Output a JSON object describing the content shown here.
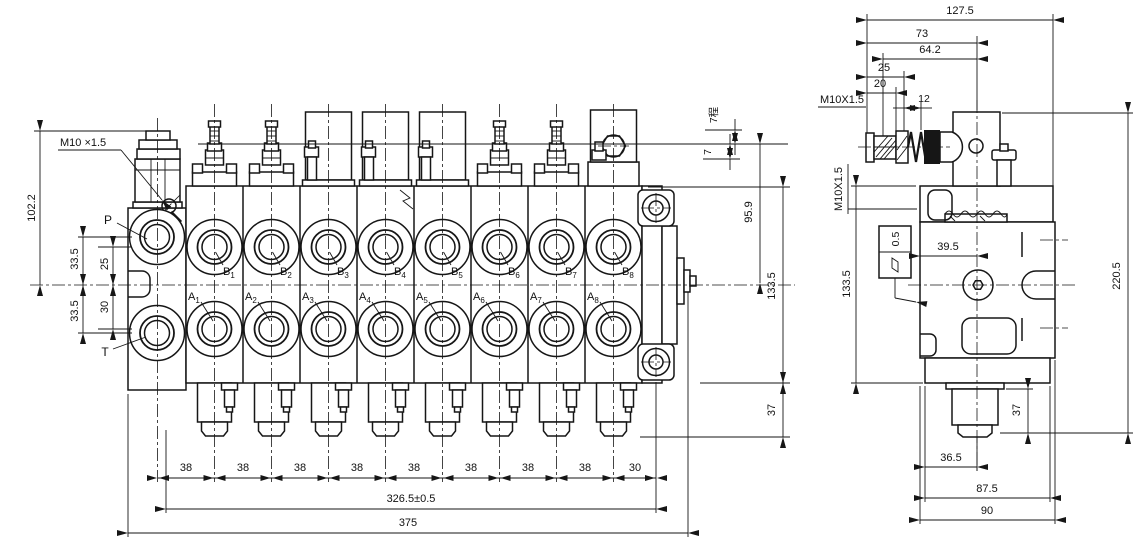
{
  "front": {
    "thread_label": "M10 ×1.5",
    "port_p": "P",
    "port_t": "T",
    "port_letter_a": "A",
    "port_letter_b": "B",
    "indices": [
      "1",
      "2",
      "3",
      "4",
      "5",
      "6",
      "7",
      "8"
    ],
    "dims": {
      "height_102": "102.2",
      "p_off": "33.5",
      "b_off": "25",
      "a_off": "30",
      "t_off": "33.5",
      "pitch": "38",
      "pitch_end": "30",
      "total_mid": "326.5±0.5",
      "total": "375",
      "stroke_up": "7程",
      "stroke_down": "7",
      "h_95": "95.9",
      "h_133": "133.5",
      "plug_37": "37"
    }
  },
  "side": {
    "dims": {
      "w_127": "127.5",
      "w_73": "73",
      "w_64": "64.2",
      "w_25": "25",
      "w_20": "20",
      "w_12": "12",
      "thread_top": "M10X1.5",
      "thread_side": "M10X1.5",
      "h_133": "133.5",
      "flatness": "0.5",
      "w_39": "39.5",
      "h_220": "220.5",
      "plug_37": "37",
      "w_36": "36.5",
      "w_87": "87.5",
      "w_90": "90"
    }
  }
}
